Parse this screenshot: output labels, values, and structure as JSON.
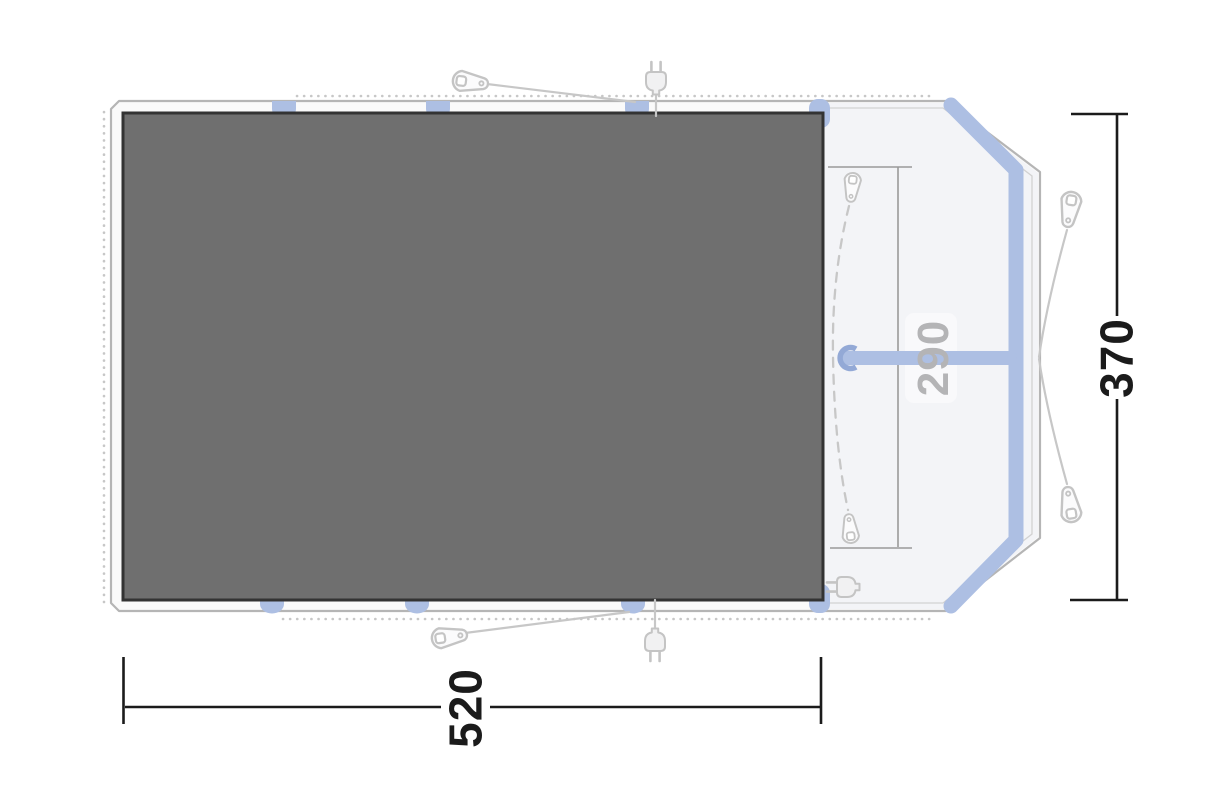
{
  "diagram": {
    "type": "tent-floorplan-top-view",
    "dimensions": {
      "width": "520",
      "depth": "370",
      "porch_width": "290"
    },
    "icons": {
      "peg": "tent-peg-icon",
      "plug": "power-plug-icon",
      "pole_hook": "pole-hook-icon",
      "pole_foot": "pole-foot-icon"
    },
    "colors": {
      "page_bg": "#ffffff",
      "tent_fill": "#fafafa",
      "porch_fill": "#f3f4f7",
      "outline_gray": "#b5b5b5",
      "outline_inner_gray": "#d2d2d2",
      "groundsheet_fill": "#6f6f6f",
      "groundsheet_border": "#333333",
      "pole_blue": "#adbfe3",
      "hook_blue": "#93a9d6",
      "guide_gray": "#c7c7c7",
      "icon_gray": "#c4c4c4",
      "dim_black": "#1b1b1b",
      "dim_gray": "#9a9a9a",
      "label_gray": "#b4b4b6"
    }
  }
}
